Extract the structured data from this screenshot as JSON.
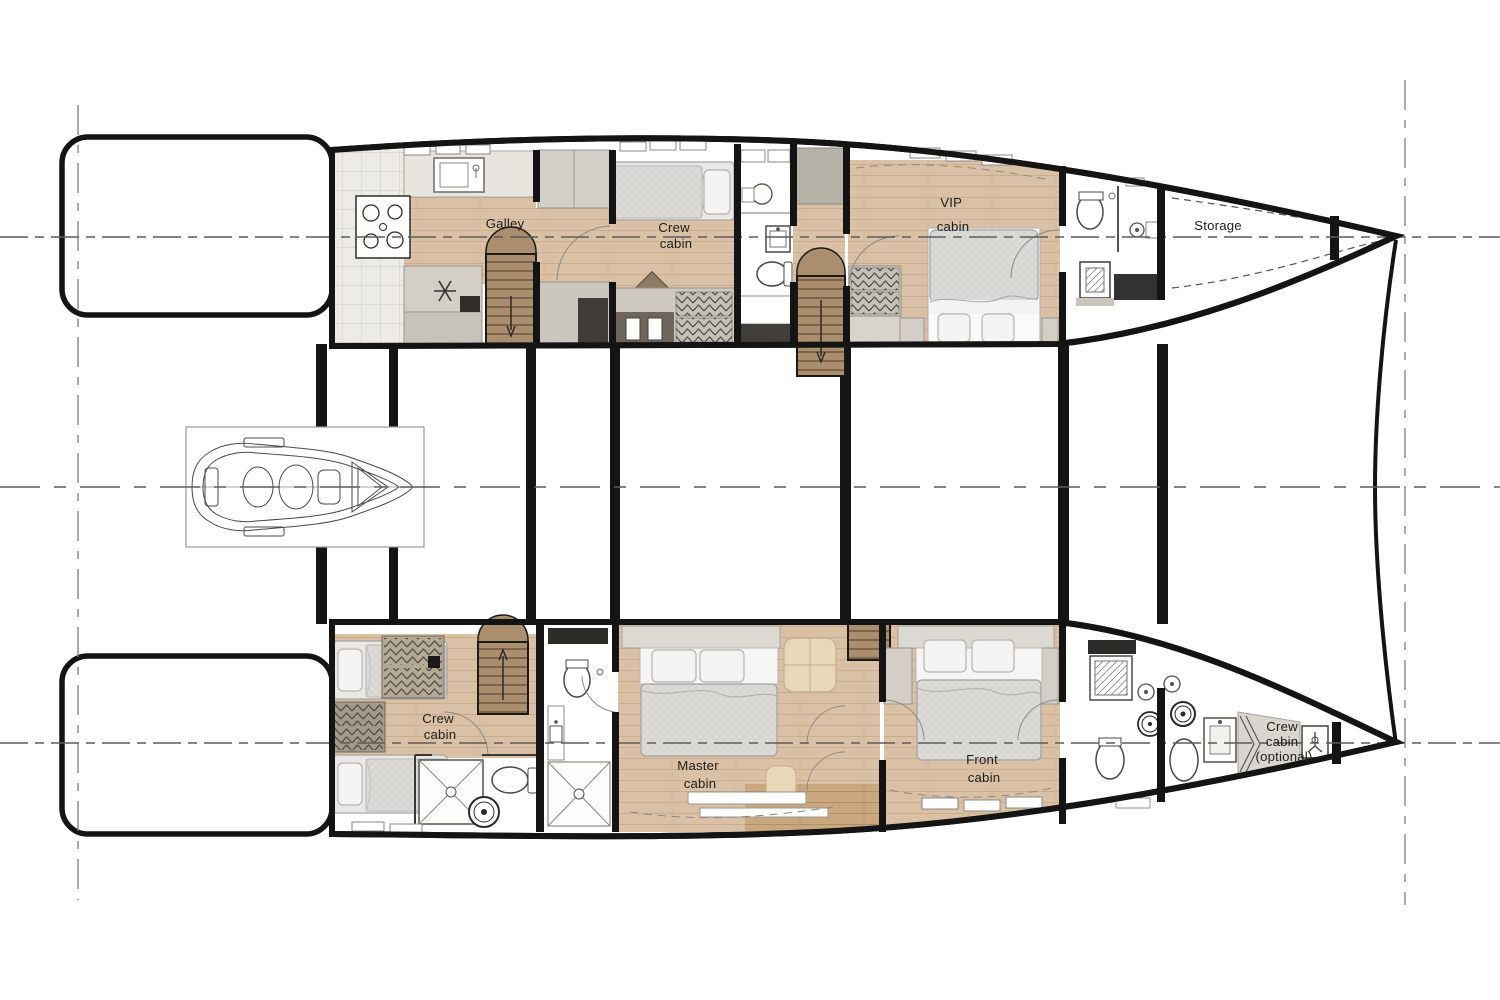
{
  "plan": {
    "type": "catamaran-lower-deck-floor-plan",
    "rooms": {
      "galley": {
        "label": "Galley"
      },
      "crew_cabin_port": {
        "label": "Crew cabin",
        "lines": [
          "Crew",
          "cabin"
        ]
      },
      "vip_cabin": {
        "label": "VIP cabin",
        "lines": [
          "VIP",
          "cabin"
        ]
      },
      "storage": {
        "label": "Storage"
      },
      "crew_cabin_starboard": {
        "label": "Crew cabin",
        "lines": [
          "Crew",
          "cabin"
        ]
      },
      "master_cabin": {
        "label": "Master cabin",
        "lines": [
          "Master",
          "cabin"
        ]
      },
      "front_cabin": {
        "label": "Front cabin",
        "lines": [
          "Front",
          "cabin"
        ]
      },
      "crew_cabin_optional": {
        "label": "Crew cabin (optional)",
        "lines": [
          "Crew",
          "cabin",
          "(optional)"
        ]
      }
    },
    "colors": {
      "wall": "#141414",
      "wood_floor": "#d9c0a4",
      "wood_dark": "#c9a87f",
      "stair_wood": "#ab8e6e",
      "tile": "#ecebe5",
      "cabinet": "#d3cfc6",
      "cabinet_dark": "#6e665c",
      "bed_linen": "#e6e5e2",
      "sofa_beige": "#e8d8b8",
      "construction_line": "#6f6f6f"
    }
  }
}
